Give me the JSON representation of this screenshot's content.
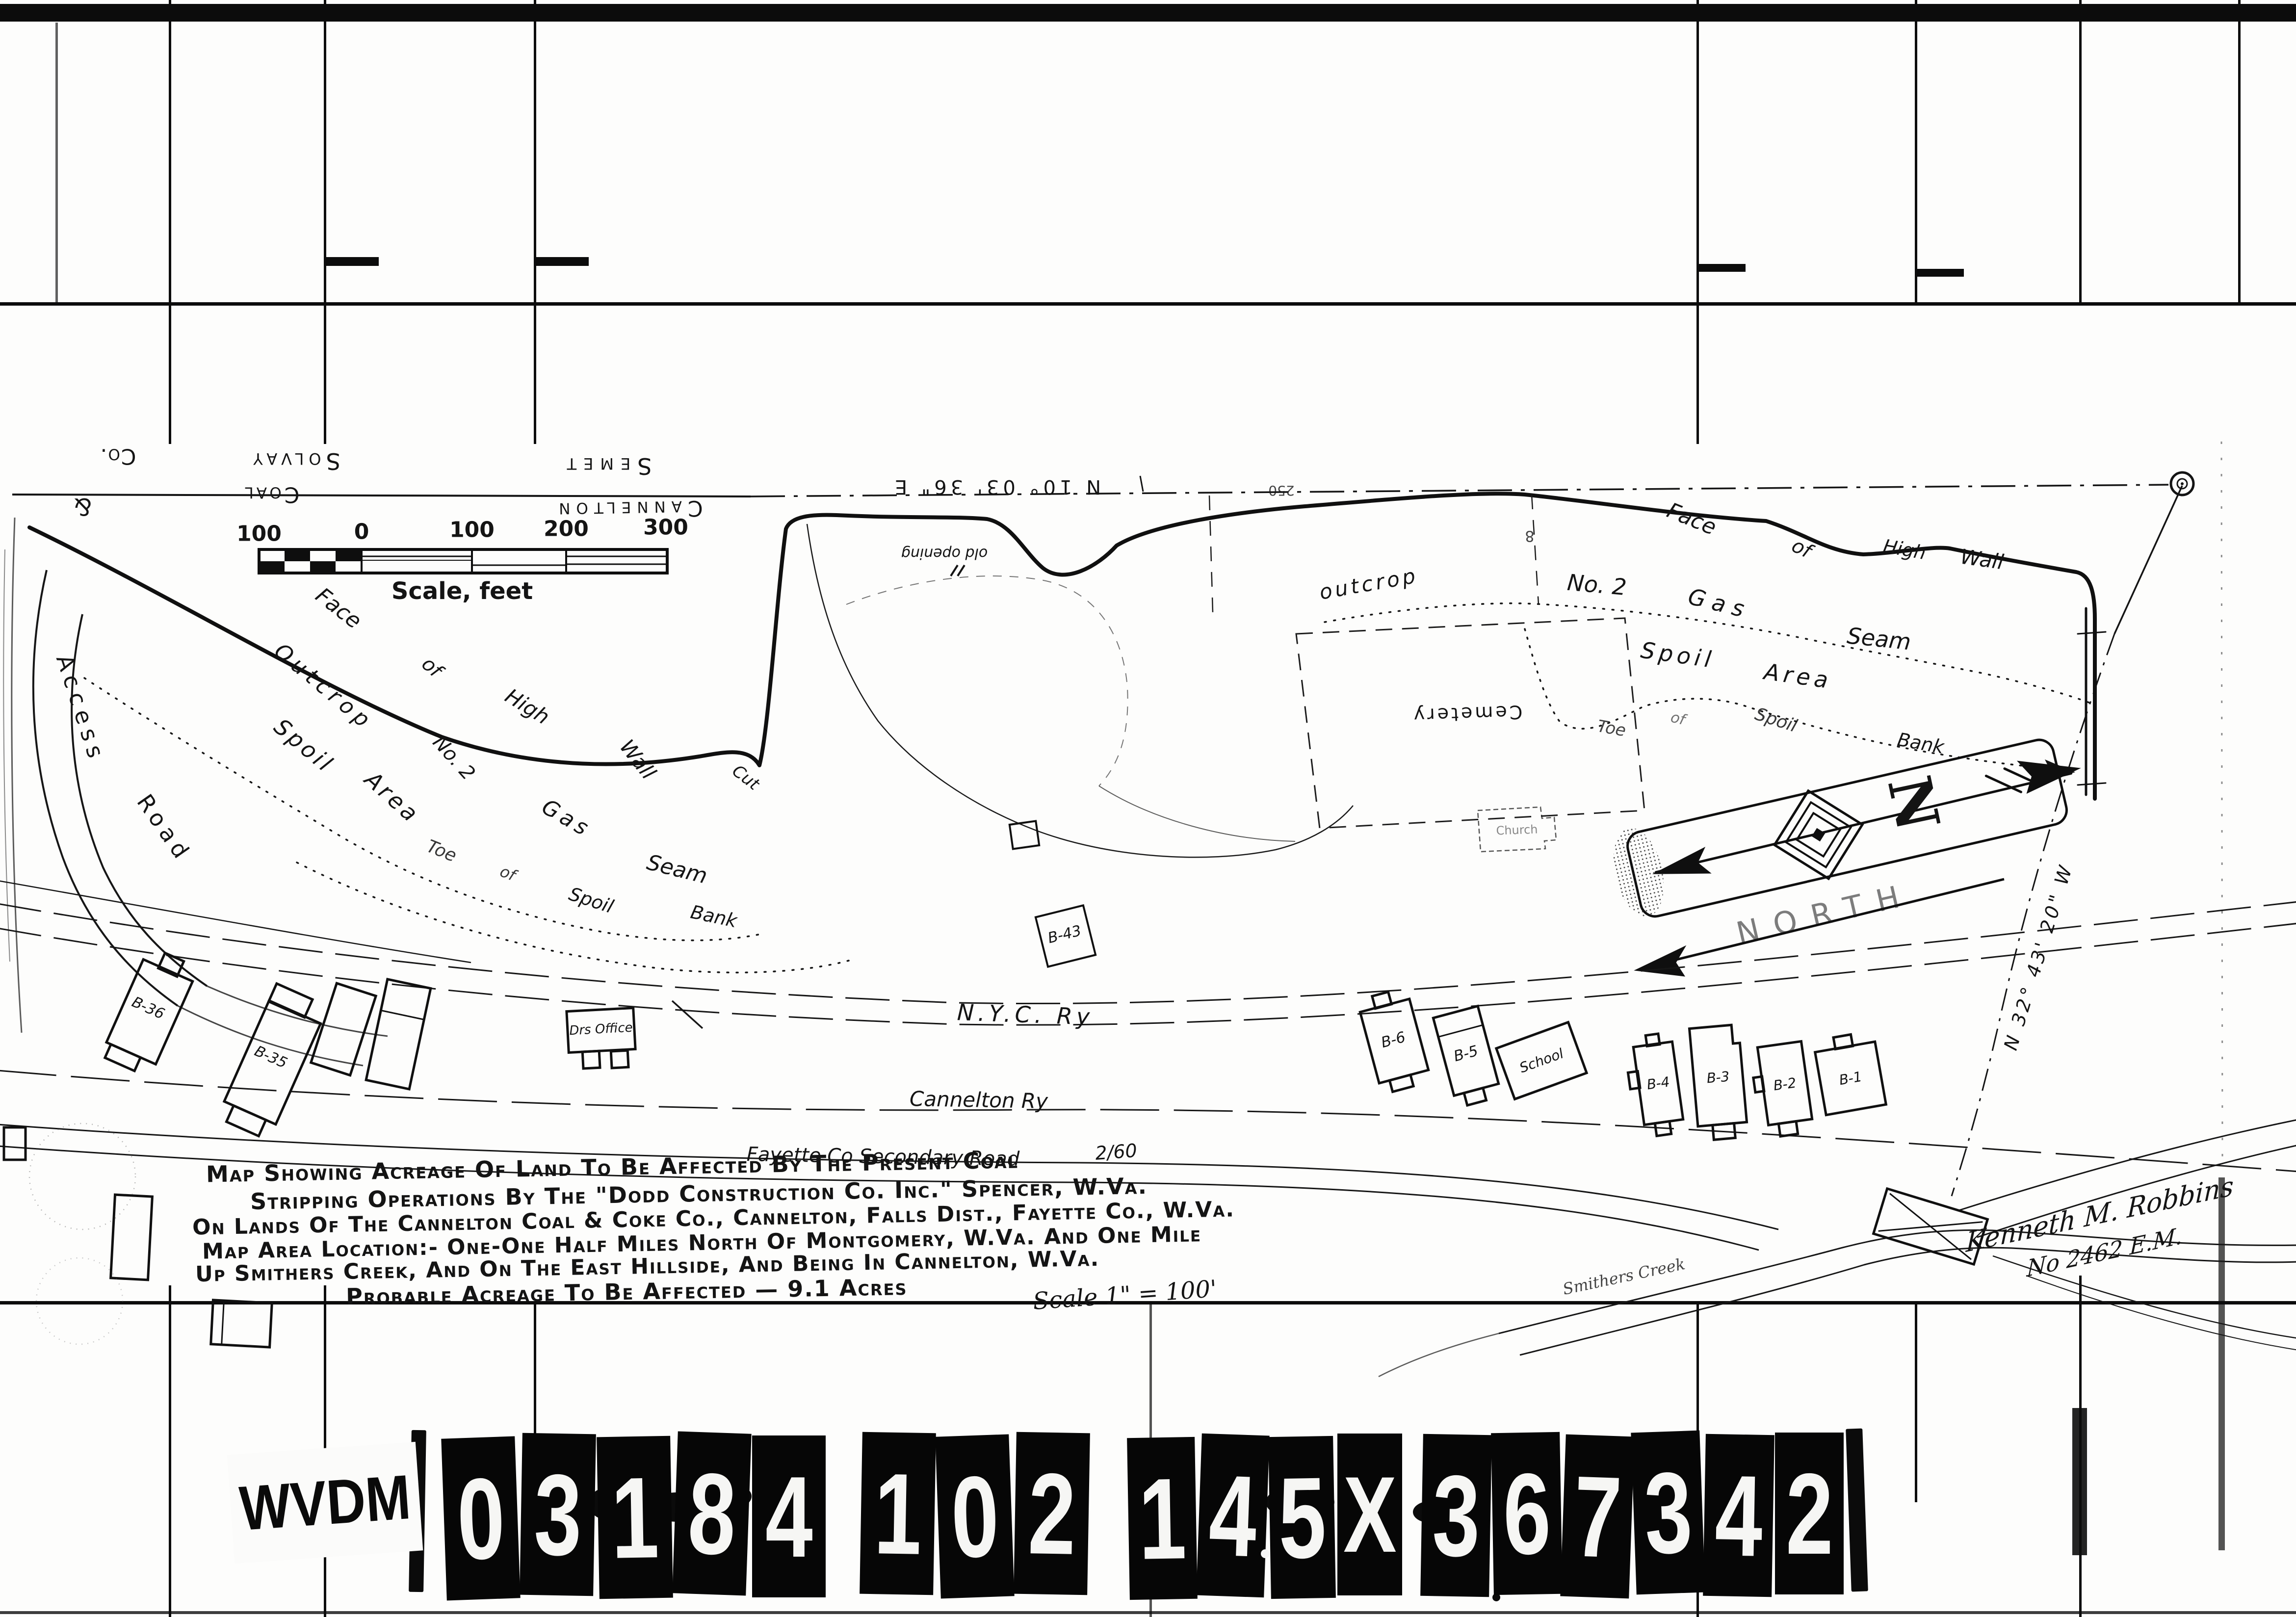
{
  "map": {
    "boundary": {
      "owner_top_1": "Semet",
      "owner_top_2": "Solvay",
      "owner_top_3": "Co.",
      "owner_bottom_1": "Cannelton",
      "owner_bottom_2": "Coal",
      "owner_bottom_3": "&",
      "bearing_top": "N 10° 03' 36\" E",
      "bearing_right": "N 32° 43' 20\" W",
      "station_250": "250",
      "station_8": "8"
    },
    "labels": {
      "face_left_1": "Face",
      "face_left_2": "of",
      "face_left_3": "High",
      "face_left_4": "Wall",
      "cut": "Cut",
      "outcrop_left_1": "Outcrop",
      "outcrop_left_2": "No. 2",
      "outcrop_left_3": "Gas",
      "outcrop_left_4": "Seam",
      "spoil_left_1": "Spoil",
      "spoil_left_2": "Area",
      "toe_left_1": "Toe",
      "toe_left_2": "of",
      "toe_left_3": "Spoil",
      "toe_left_4": "Bank",
      "face_right_1": "Face",
      "face_right_2": "of",
      "face_right_3": "High",
      "face_right_4": "Wall",
      "outcrop_right_1": "outcrop",
      "outcrop_right_2": "No. 2",
      "outcrop_right_3": "Gas",
      "outcrop_right_4": "Seam",
      "spoil_right_1": "Spoil",
      "spoil_right_2": "Area",
      "toe_right_1": "Toe",
      "toe_right_2": "of",
      "toe_right_3": "Spoil",
      "toe_right_4": "Bank",
      "old_opening": "old opening",
      "cemetery": "Cemetery",
      "church": "Church",
      "north_word": "NORTH",
      "north_n": "N",
      "access_1": "Access",
      "access_2": "Road",
      "nyc_ry": "N.Y.C. Ry",
      "cannelton_ry": "Cannelton Ry",
      "fayette_road": "Fayette Co Secondary Road",
      "fayette_road_num": "2/60",
      "smithers_creek": "Smithers Creek"
    },
    "buildings": {
      "b36": "B-36",
      "b35": "B-35",
      "drs_office": "Drs Office",
      "b43": "B-43",
      "b6": "B-6",
      "b5": "B-5",
      "school": "School",
      "b4": "B-4",
      "b3": "B-3",
      "b2": "B-2",
      "b1": "B-1"
    },
    "scale_bar": {
      "ticks": [
        "100",
        "0",
        "100",
        "200",
        "300"
      ],
      "caption": "Scale, feet"
    },
    "title_block": {
      "line1": "Map Showing Acreage Of Land To Be Affected By The Present Coal",
      "line2": "Stripping Operations By The \"Dodd Construction Co. Inc.\" Spencer, W.Va.",
      "line3": "On Lands Of The Cannelton Coal & Coke Co., Cannelton, Falls Dist., Fayette Co., W.Va.",
      "line4": "Map Area Location:- One-One Half Miles North Of Montgomery, W.Va. And One Mile",
      "line5": "Up Smithers Creek, And On The East Hillside, And Being In Cannelton, W.Va.",
      "line6": "Probable Acreage To Be Affected — 9.1 Acres",
      "scale_note": "Scale 1\" = 100'"
    },
    "signature": {
      "name": "Kenneth M. Robbins",
      "license": "No 2462 E.M."
    }
  },
  "film_strip": {
    "agency": "WVDM",
    "tiles": [
      "0",
      "3",
      "1",
      "8",
      "4",
      "1",
      "0",
      "2",
      "1",
      "4",
      "5",
      "X",
      "3",
      "6",
      "7",
      "3",
      "4",
      "2"
    ]
  }
}
